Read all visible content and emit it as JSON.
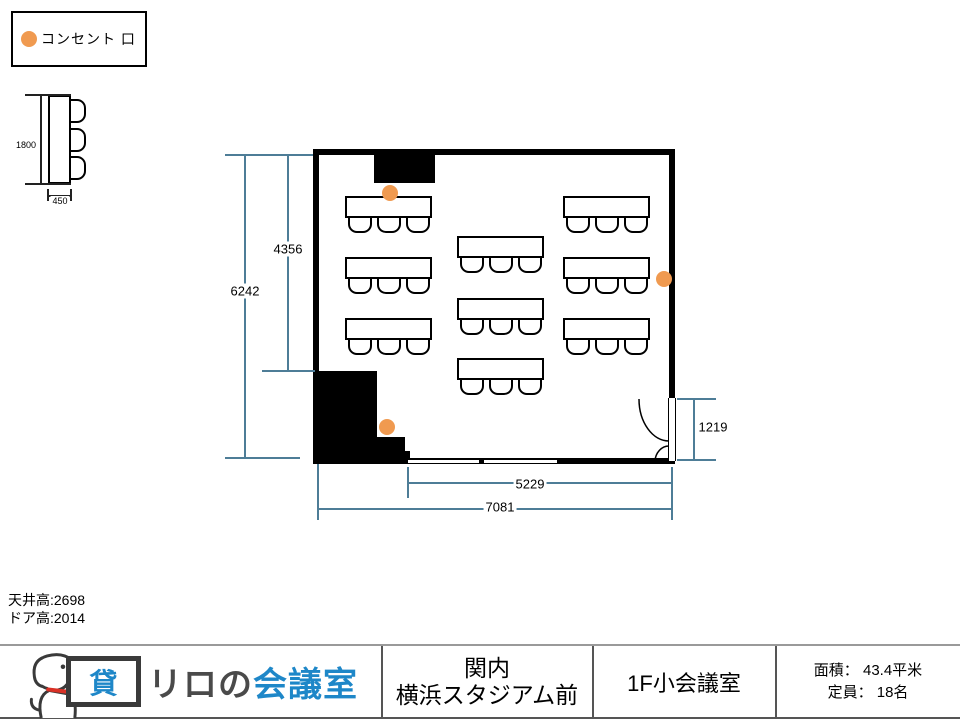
{
  "legend": {
    "label": "コンセント 口"
  },
  "colors": {
    "outlet": "#F09A50",
    "dimension_line": "#4E7D97",
    "brand_blue": "#1E87C8",
    "brand_gray": "#4A4A4A",
    "collar_red": "#D93025"
  },
  "mini_table": {
    "length": "1800",
    "depth": "450"
  },
  "dimensions": {
    "room_depth_outer": "6242",
    "room_depth_inner": "4356",
    "door_width": "1219",
    "room_width_inner": "5229",
    "room_width_outer": "7081"
  },
  "notes": {
    "ceiling_height": "天井高:2698",
    "door_height": "ドア高:2014"
  },
  "floorplan": {
    "tables": [
      {
        "x": 345,
        "y": 196,
        "chairs": 3
      },
      {
        "x": 345,
        "y": 257,
        "chairs": 3
      },
      {
        "x": 345,
        "y": 318,
        "chairs": 3
      },
      {
        "x": 457,
        "y": 236,
        "chairs": 3
      },
      {
        "x": 457,
        "y": 298,
        "chairs": 3
      },
      {
        "x": 457,
        "y": 358,
        "chairs": 3
      },
      {
        "x": 563,
        "y": 196,
        "chairs": 3
      },
      {
        "x": 563,
        "y": 257,
        "chairs": 3
      },
      {
        "x": 563,
        "y": 318,
        "chairs": 3
      }
    ],
    "outlets": [
      {
        "x": 390,
        "y": 193
      },
      {
        "x": 664,
        "y": 279
      },
      {
        "x": 387,
        "y": 427
      }
    ]
  },
  "footer": {
    "badge_char": "貸",
    "brand_gray_text": "リロの",
    "brand_blue_text": "会議室",
    "location_line1": "関内",
    "location_line2": "横浜スタジアム前",
    "room_name": "1F小会議室",
    "area_label": "面積：",
    "area_value": "43.4平米",
    "capacity_label": "定員：",
    "capacity_value": "18名"
  }
}
